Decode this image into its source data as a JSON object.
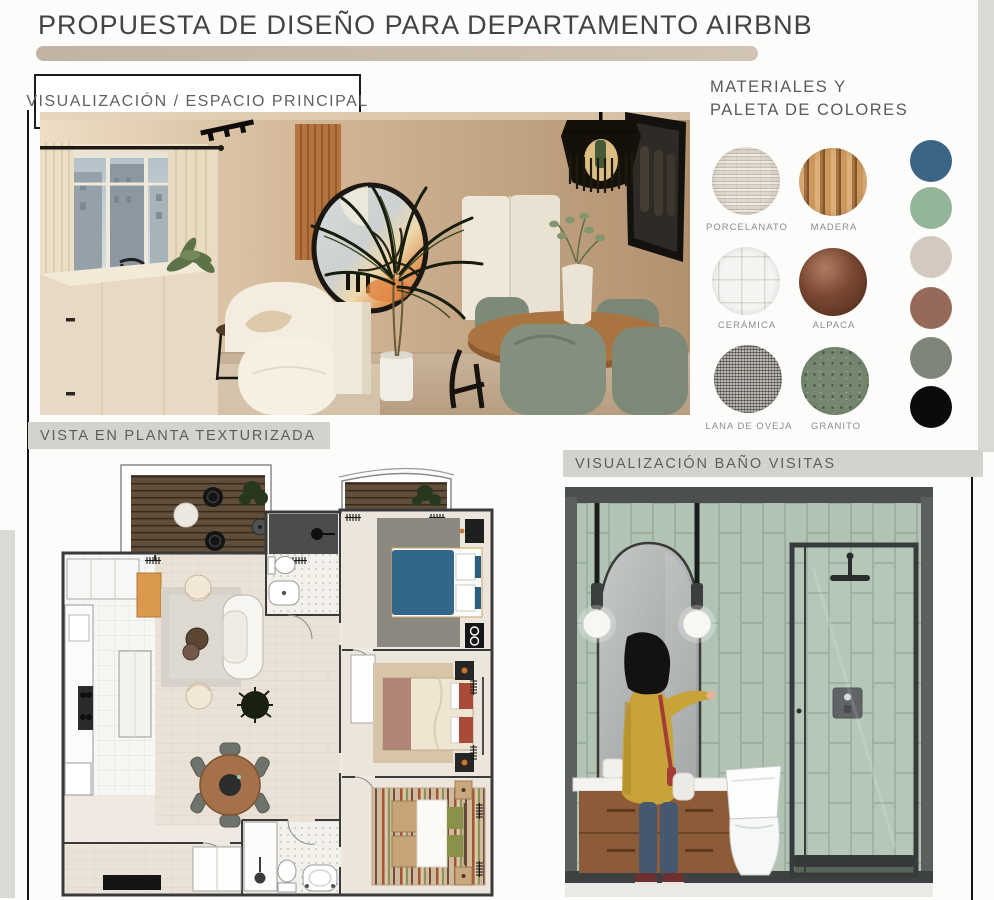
{
  "page": {
    "title": "PROPUESTA DE DISEÑO PARA DEPARTAMENTO AIRBNB"
  },
  "sections": {
    "main_visualization": {
      "label": "VISUALIZACIÓN / ESPACIO PRINCIPAL"
    },
    "floor_plan": {
      "label": "VISTA EN PLANTA TEXTURIZADA"
    },
    "guest_bathroom": {
      "label": "VISUALIZACIÓN BAÑO VISITAS"
    }
  },
  "materials": {
    "heading_line1": "MATERIALES Y",
    "heading_line2": "PALETA DE COLORES",
    "swatches": [
      {
        "label": "PORCELANATO",
        "base_color": "#d8d0c4"
      },
      {
        "label": "MADERA",
        "base_color": "#c08b52"
      },
      {
        "label": "CERÁMICA",
        "base_color": "#f4f4f2"
      },
      {
        "label": "ALPACA",
        "base_color": "#84503b"
      },
      {
        "label": "LANA DE OVEJA",
        "base_color": "#bcb9b2"
      },
      {
        "label": "GRANITO",
        "base_color": "#75886f"
      }
    ],
    "palette": [
      {
        "name": "azul-petroleo",
        "color": "#3a6585"
      },
      {
        "name": "verde-salvia",
        "color": "#92b697"
      },
      {
        "name": "greige",
        "color": "#d4c9bf"
      },
      {
        "name": "terracota",
        "color": "#97695a"
      },
      {
        "name": "verde-oliva",
        "color": "#7f8578"
      },
      {
        "name": "negro",
        "color": "#0b0b0b"
      }
    ]
  },
  "accents": {
    "title_bar": "#cdbfae",
    "label_bar_bg": "#d2d2cf",
    "edge_strip": "#d9d9d6"
  }
}
